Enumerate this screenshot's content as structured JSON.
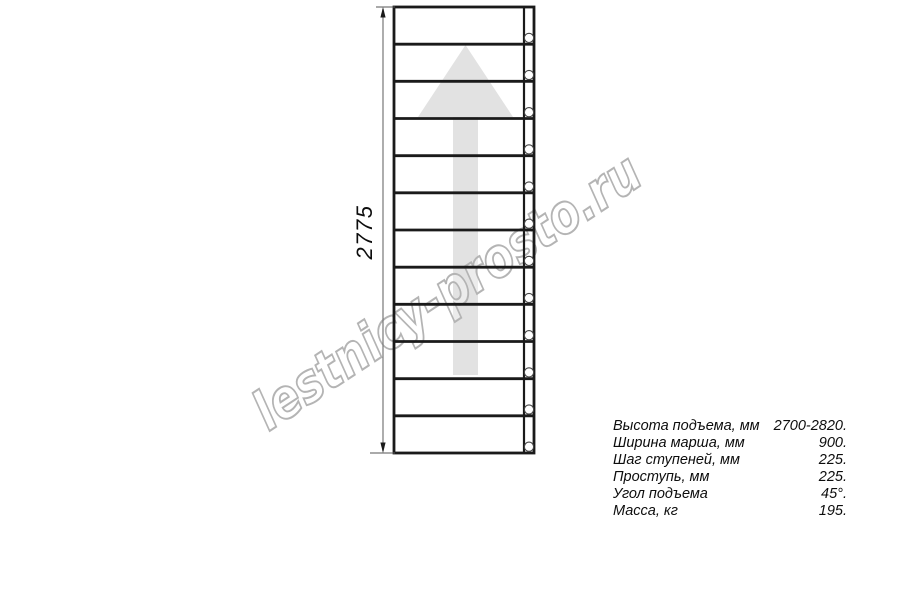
{
  "drawing": {
    "dimension_label": "2775",
    "watermark": "lestnicy-prosto.ru",
    "steps_count": 12,
    "holes_count": 12
  },
  "specs": {
    "rows": [
      {
        "label": "Высота подъема, мм",
        "value": "2700-2820."
      },
      {
        "label": "Ширина марша, мм",
        "value": "900."
      },
      {
        "label": "Шаг ступеней, мм",
        "value": "225."
      },
      {
        "label": "Проступь, мм",
        "value": "225."
      },
      {
        "label": "Угол подъема",
        "value": "45°."
      },
      {
        "label": "Масса, кг",
        "value": "195."
      }
    ]
  },
  "colors": {
    "background": "#ffffff",
    "line": "#1a1a1a",
    "thin_line": "#555555",
    "dimension_line": "#777777",
    "arrow_fill": "#e2e2e2",
    "watermark_stroke": "#b4b4b4",
    "text": "#0d0d0d"
  }
}
